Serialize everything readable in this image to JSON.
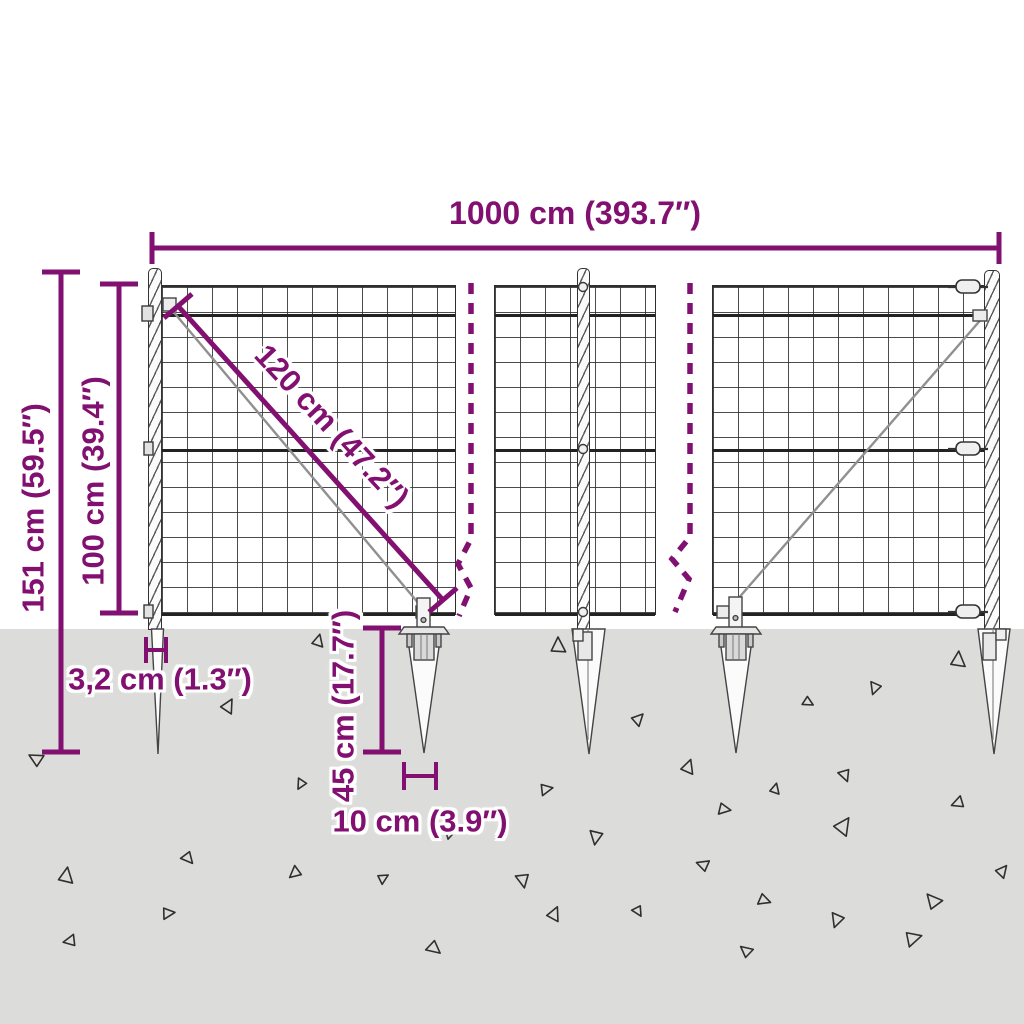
{
  "diagram": {
    "title": "wire-mesh-fence-with-ground-spikes-dimension-diagram",
    "labels": {
      "total_width": "1000 cm (393.7″)",
      "total_height": "151 cm (59.5″)",
      "mesh_height": "100 cm (39.4″)",
      "brace_length": "120 cm (47.2″)",
      "post_width": "3,2 cm (1.3″)",
      "spike_depth": "45 cm (17.7″)",
      "spike_top_width": "10 cm (3.9″)"
    },
    "colors": {
      "dimension_purple": "#821070",
      "ground_gray": "#dcdcda",
      "wire_dark": "#2e2e2e"
    },
    "structure": {
      "panels": 3,
      "posts": 3,
      "ground_spikes": 5,
      "break_marks": 2
    },
    "ground": {
      "triangles": [
        {
          "x": 318,
          "y": 641,
          "s": 7,
          "r": 15
        },
        {
          "x": 558,
          "y": 646,
          "s": 9,
          "r": 0
        },
        {
          "x": 958,
          "y": 660,
          "s": 9,
          "r": 5
        },
        {
          "x": 875,
          "y": 688,
          "s": 7,
          "r": 200
        },
        {
          "x": 228,
          "y": 706,
          "s": 8,
          "r": 30
        },
        {
          "x": 808,
          "y": 702,
          "s": 6,
          "r": 120
        },
        {
          "x": 638,
          "y": 719,
          "s": 7,
          "r": 45
        },
        {
          "x": 36,
          "y": 759,
          "s": 8,
          "r": 300
        },
        {
          "x": 688,
          "y": 767,
          "s": 8,
          "r": 20
        },
        {
          "x": 845,
          "y": 775,
          "s": 7,
          "r": 160
        },
        {
          "x": 301,
          "y": 784,
          "s": 6,
          "r": 210
        },
        {
          "x": 546,
          "y": 789,
          "s": 7,
          "r": 80
        },
        {
          "x": 775,
          "y": 789,
          "s": 6,
          "r": 15
        },
        {
          "x": 958,
          "y": 803,
          "s": 7,
          "r": 250
        },
        {
          "x": 724,
          "y": 809,
          "s": 7,
          "r": 100
        },
        {
          "x": 843,
          "y": 826,
          "s": 10,
          "r": 35
        },
        {
          "x": 596,
          "y": 837,
          "s": 8,
          "r": 190
        },
        {
          "x": 450,
          "y": 833,
          "s": 6,
          "r": 70
        },
        {
          "x": 188,
          "y": 858,
          "s": 7,
          "r": 140
        },
        {
          "x": 66,
          "y": 876,
          "s": 9,
          "r": 10
        },
        {
          "x": 295,
          "y": 873,
          "s": 7,
          "r": 230
        },
        {
          "x": 383,
          "y": 878,
          "s": 6,
          "r": 60
        },
        {
          "x": 523,
          "y": 880,
          "s": 8,
          "r": 170
        },
        {
          "x": 703,
          "y": 865,
          "s": 7,
          "r": 290
        },
        {
          "x": 1002,
          "y": 871,
          "s": 7,
          "r": 40
        },
        {
          "x": 764,
          "y": 900,
          "s": 7,
          "r": 110
        },
        {
          "x": 933,
          "y": 901,
          "s": 9,
          "r": 320
        },
        {
          "x": 168,
          "y": 913,
          "s": 7,
          "r": 85
        },
        {
          "x": 554,
          "y": 914,
          "s": 8,
          "r": 25
        },
        {
          "x": 638,
          "y": 911,
          "s": 6,
          "r": 150
        },
        {
          "x": 837,
          "y": 920,
          "s": 8,
          "r": 200
        },
        {
          "x": 913,
          "y": 938,
          "s": 9,
          "r": 75
        },
        {
          "x": 70,
          "y": 941,
          "s": 7,
          "r": 260
        },
        {
          "x": 434,
          "y": 948,
          "s": 8,
          "r": 130
        },
        {
          "x": 746,
          "y": 951,
          "s": 7,
          "r": 310
        }
      ]
    }
  }
}
